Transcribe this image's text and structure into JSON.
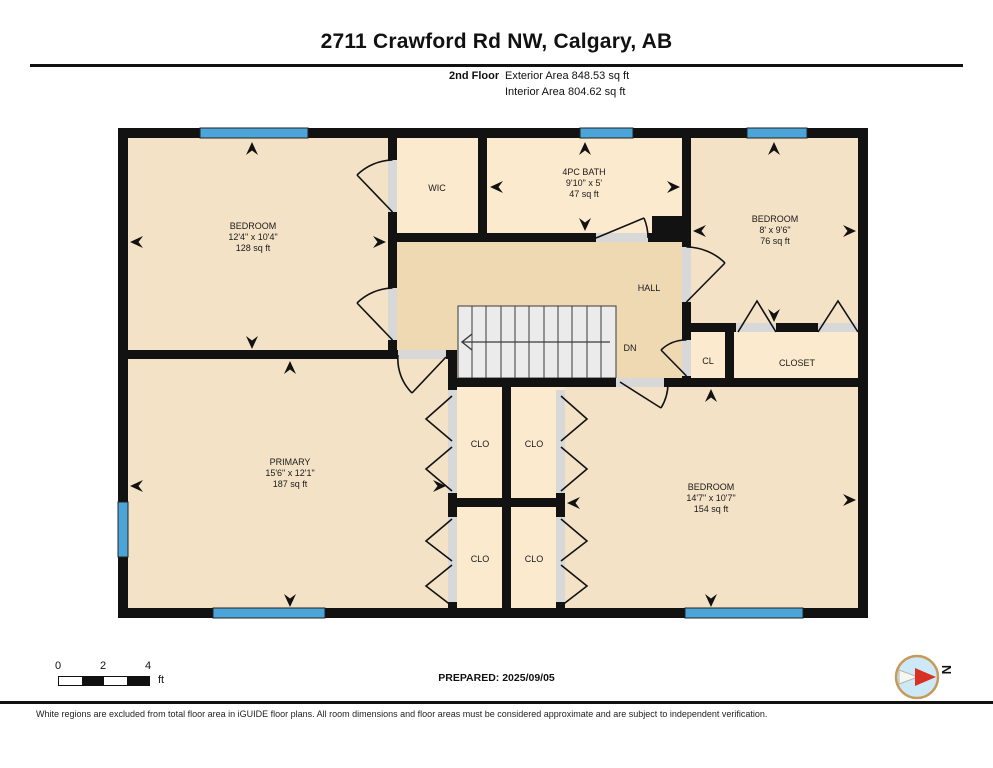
{
  "title": "2711 Crawford Rd NW, Calgary, AB",
  "floor_info": {
    "floor": "2nd Floor",
    "exterior_area": "Exterior Area 848.53 sq ft",
    "interior_area": "Interior Area 804.62 sq ft"
  },
  "rooms": {
    "bedroom_nw": {
      "label": "BEDROOM",
      "dimensions": "12'4\" x 10'4\"",
      "area": "128 sq ft"
    },
    "wic": {
      "label": "WIC"
    },
    "bath": {
      "label": "4PC BATH",
      "dimensions": "9'10\" x 5'",
      "area": "47 sq ft"
    },
    "bedroom_ne": {
      "label": "BEDROOM",
      "dimensions": "8' x 9'6\"",
      "area": "76 sq ft"
    },
    "hall": {
      "label": "HALL"
    },
    "stairs": {
      "label": "DN"
    },
    "cl": {
      "label": "CL"
    },
    "closet": {
      "label": "CLOSET"
    },
    "primary": {
      "label": "PRIMARY",
      "dimensions": "15'6\" x 12'1\"",
      "area": "187 sq ft"
    },
    "clo_nw": {
      "label": "CLO"
    },
    "clo_ne": {
      "label": "CLO"
    },
    "clo_sw": {
      "label": "CLO"
    },
    "clo_se": {
      "label": "CLO"
    },
    "bedroom_se": {
      "label": "BEDROOM",
      "dimensions": "14'7\" x 10'7\"",
      "area": "154 sq ft"
    }
  },
  "scale_bar": {
    "tick_0": "0",
    "tick_2": "2",
    "tick_4": "4",
    "unit": "ft"
  },
  "prepared": "PREPARED: 2025/09/05",
  "compass": {
    "north_label": "N"
  },
  "disclaimer": "White regions are excluded from total floor area in iGUIDE floor plans. All room dimensions and floor areas must be considered approximate and are subject to independent verification.",
  "colors": {
    "room_fill": "#f3e2c6",
    "hall_fill": "#efd9b3",
    "closet_fill": "#fceacf",
    "window_blue": "#4ca5d8",
    "wall_black": "#121212",
    "door_sill_gray": "#d8d8d8",
    "stair_fill": "#ebebeb",
    "compass_red": "#d93025",
    "compass_face_blue": "#cde9f7"
  }
}
